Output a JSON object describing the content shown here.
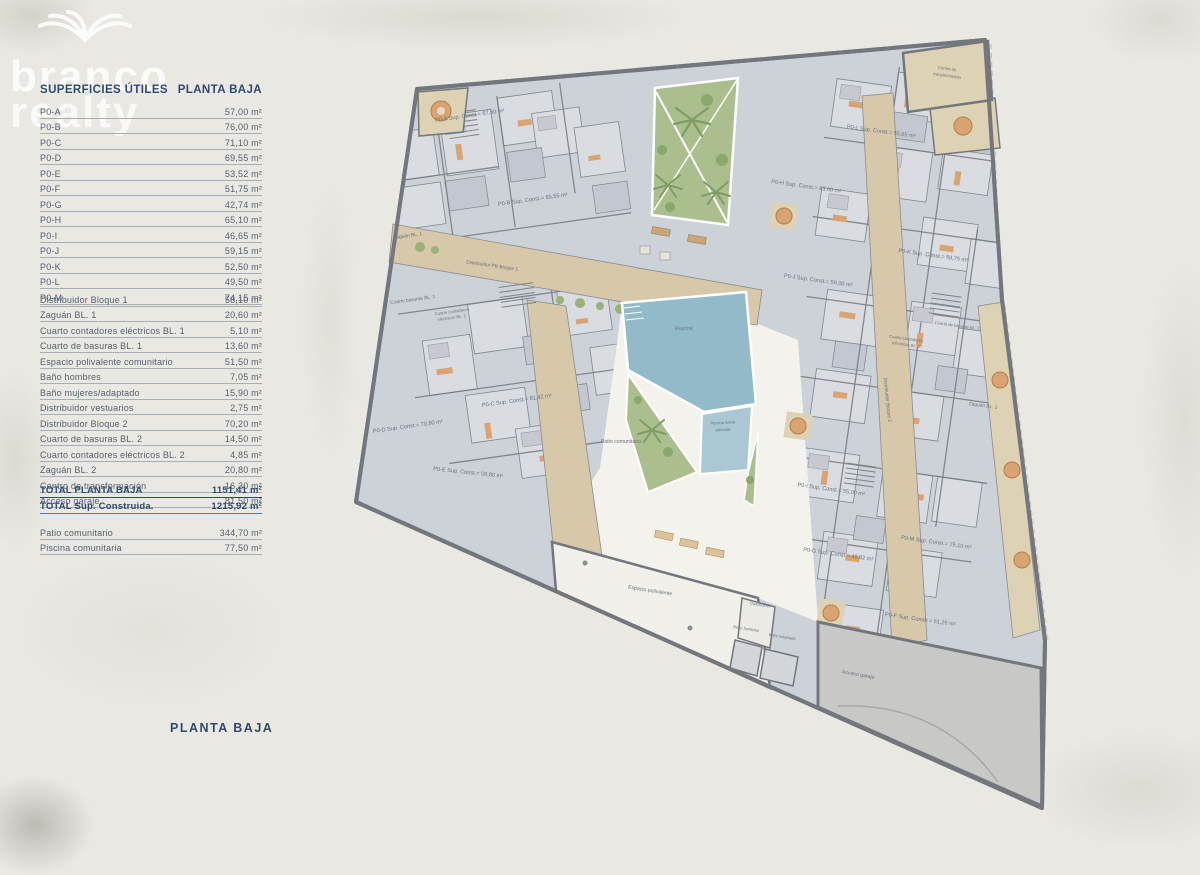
{
  "branding": {
    "logo_line1": "branco",
    "logo_line2": "realty"
  },
  "sidebar": {
    "header_left": "SUPERFICIES ÚTILES",
    "header_right": "PLANTA BAJA",
    "units": [
      {
        "label": "P0-A",
        "value": "57,00 m²"
      },
      {
        "label": "P0-B",
        "value": "76,00 m²"
      },
      {
        "label": "P0-C",
        "value": "71,10 m²"
      },
      {
        "label": "P0-D",
        "value": "69,55 m²"
      },
      {
        "label": "P0-E",
        "value": "53,52 m²"
      },
      {
        "label": "P0-F",
        "value": "51,75 m²"
      },
      {
        "label": "P0-G",
        "value": "42,74 m²"
      },
      {
        "label": "P0-H",
        "value": "65,10 m²"
      },
      {
        "label": "P0-I",
        "value": "46,65 m²"
      },
      {
        "label": "P0-J",
        "value": "59,15 m²"
      },
      {
        "label": "P0-K",
        "value": "52,50 m²"
      },
      {
        "label": "P0-L",
        "value": "49,50 m²"
      },
      {
        "label": "P0-M",
        "value": "74,15 m²"
      }
    ],
    "common_areas": [
      {
        "label": "Distribuidor Bloque 1",
        "value": "58,10 m²"
      },
      {
        "label": "Zaguán BL. 1",
        "value": "20,60 m²"
      },
      {
        "label": "Cuarto contadores eléctricos BL. 1",
        "value": "5,10 m²"
      },
      {
        "label": "Cuarto de basuras BL. 1",
        "value": "13,60 m²"
      },
      {
        "label": "Espacio polivalente comunitario",
        "value": "51,50 m²"
      },
      {
        "label": "Baño hombres",
        "value": "7,05 m²"
      },
      {
        "label": "Baño mujeres/adaptado",
        "value": "15,90 m²"
      },
      {
        "label": "Distribuidor vestuarios",
        "value": "2,75 m²"
      },
      {
        "label": "Distribuidor Bloque 2",
        "value": "70,20 m²"
      },
      {
        "label": "Cuarto de basuras BL. 2",
        "value": "14,50 m²"
      },
      {
        "label": "Cuarto contadores eléctricos BL. 2",
        "value": "4,85 m²"
      },
      {
        "label": "Zaguán BL. 2",
        "value": "20,80 m²"
      },
      {
        "label": "Centro de transformación",
        "value": "16,30 m²"
      },
      {
        "label": "Acceso garaje",
        "value": "81,50 m²"
      }
    ],
    "totals": [
      {
        "label": "TOTAL PLANTA BAJA",
        "value": "1151,41 m²"
      },
      {
        "label": "TOTAL Sup. Construida.",
        "value": "1215,92 m²"
      }
    ],
    "extras": [
      {
        "label": "Patio comunitario",
        "value": "344,70 m²"
      },
      {
        "label": "Piscina comunitaria",
        "value": "77,50 m²"
      }
    ],
    "footer_title": "PLANTA BAJA"
  },
  "plan": {
    "labels": {
      "unit_a": "P0-A Sup. Const.= 67,60 m²",
      "unit_b": "P0-B Sup. Const.= 85,55 m²",
      "unit_c": "P0-C Sup. Const.= 81,42 m²",
      "unit_d": "P0-D Sup. Const.= 70,90 m²",
      "unit_e": "P0-E Sup. Const.= 59,80 m²",
      "unit_f": "P0-F Sup. Constr.= 61,25 m²",
      "unit_g": "P0-G Sup. Const.= 49,82 m²",
      "unit_h": "P0-H Sup. Const.= 83,00 m²",
      "unit_i": "P0-I Sup. Const.= 55,00 m²",
      "unit_j": "P0-J Sup. Const.= 59,00 m²",
      "unit_k": "P0-K Sup. Const.= 59,75 m²",
      "unit_l": "P0-L Sup. Const.= 55,65 m²",
      "unit_m": "P0-M Sup. Const.= 75,10 m²",
      "zaguan1": "Zaguán BL. 1",
      "basuras1": "Cuarto basuras BL. 1",
      "contadores1a": "Cuarto contadores",
      "contadores1b": "eléctricos BL. 1",
      "distribuidor1": "Distribuidor PB Bloque 1",
      "centro1": "Centro de",
      "centro2": "transformación",
      "basuras2": "Cuarto de basuras BL. 2",
      "contadores2a": "Cuarto contadores",
      "contadores2b": "eléctricos BL. 2",
      "distribuidor2": "Distribuidor Bloque 2",
      "zaguan2": "Zaguán BL. 2",
      "piscina": "Piscina",
      "piscina_elev1": "Piscina sobre",
      "piscina_elev2": "elevada",
      "patio": "Patio comunitario",
      "espacio": "Espacio polivalente",
      "distribuidor_s": "Distribuidor",
      "bano_hombres": "Baño hombres",
      "bano_adaptado": "Baño adaptado",
      "acceso": "Acceso garaje"
    },
    "colors": {
      "wall": "#73777d",
      "apartment_floor": "#cdd2d9",
      "room_light": "#d9dce1",
      "corridor": "#d6c8a9",
      "terrace": "#ddd2b4",
      "pool": "#93bac9",
      "pool_raised": "#a9c8d4",
      "garden": "#abbf8e",
      "palm": "#7e9c66",
      "garage": "#c8c8c6",
      "courtyard": "#f4f2ed",
      "furniture_orange": "#d9a471",
      "navy_text": "#2e4a6e"
    }
  }
}
